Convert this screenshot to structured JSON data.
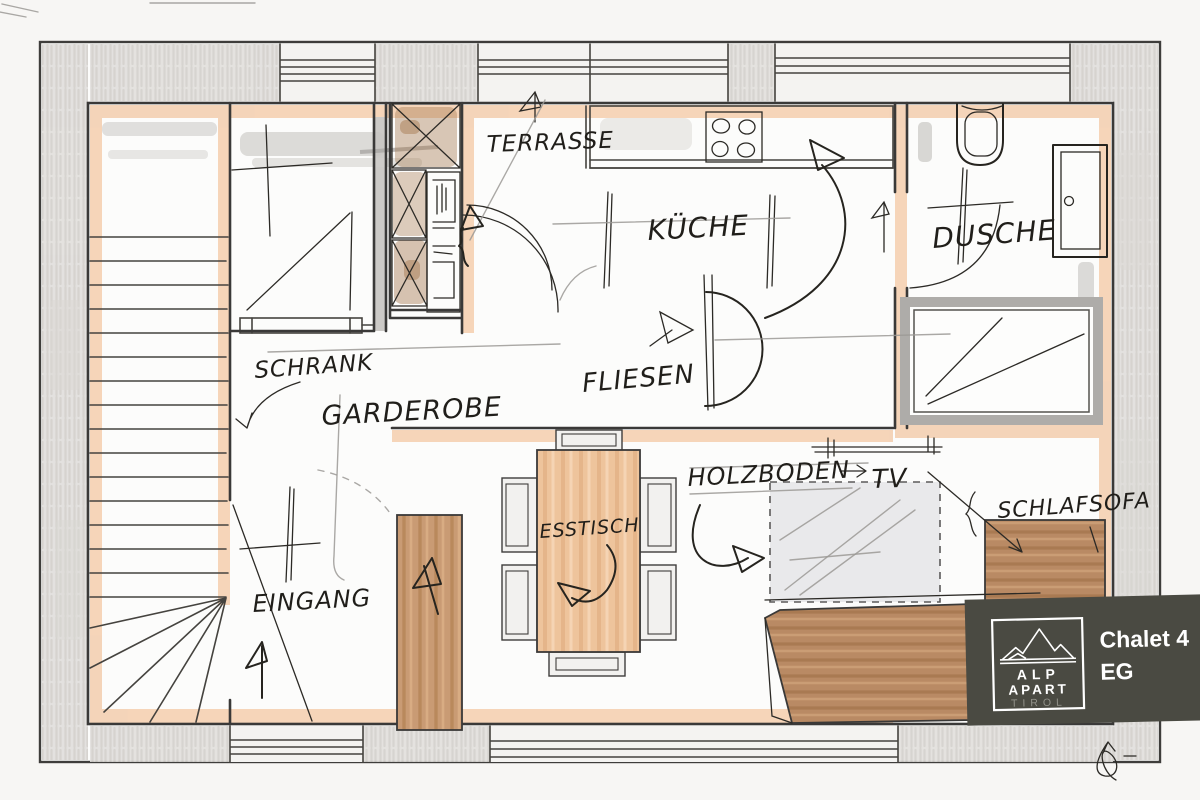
{
  "labels": {
    "terrasse": "TERRASSE",
    "kueche": "KÜCHE",
    "dusche": "DUSCHE",
    "eingang": "EINGANG",
    "schrank": "SCHRANK",
    "garderobe": "GARDEROBE",
    "fliesen": "FLIESEN",
    "holzboden": "HOLZBODEN",
    "tv": "TV",
    "schlafsofa": "SCHLAFSOFA",
    "esstisch": "ESSTISCH"
  },
  "badge": {
    "title": "Chalet 4",
    "subtitle": "EG",
    "logo": {
      "line1": "ALP",
      "line2": "APART",
      "line3": "TIROL"
    },
    "colors": {
      "background": "#4a4a42",
      "text": "#ffffff",
      "logo_border": "#ffffff",
      "tirol_text": "#92928a"
    }
  },
  "icons": {
    "stove": "stove-icon",
    "toilet": "toilet-icon",
    "shower_door": "door-icon",
    "mountains": "mountain-icon",
    "signature": "signature-scribble"
  },
  "colors": {
    "ink": "#26241f",
    "pencil": "#9b9995",
    "wall_highlight": "#f3c9a7",
    "wood_dark": "#b9855c",
    "wood_light": "#ecc29b",
    "band_gray": "#e1dfdc",
    "paper": "#fcfcfb"
  }
}
